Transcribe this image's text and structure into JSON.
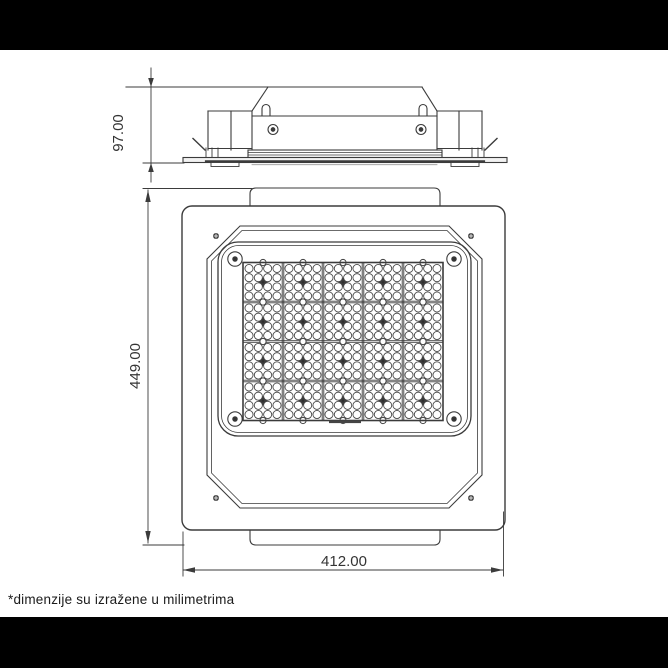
{
  "drawing": {
    "dimensions": {
      "side_height_label": "97.00",
      "front_height_label": "449.00",
      "front_width_label": "412.00"
    },
    "footnote": "*dimenzije su izražene u milimetrima",
    "led_grid": {
      "columns": 5,
      "rows": 4,
      "lens_cols_per_module": 4,
      "lens_rows_per_module": 4
    },
    "colors": {
      "line": "#3b3b3b",
      "background": "#ffffff",
      "letterbox": "#000000"
    }
  }
}
